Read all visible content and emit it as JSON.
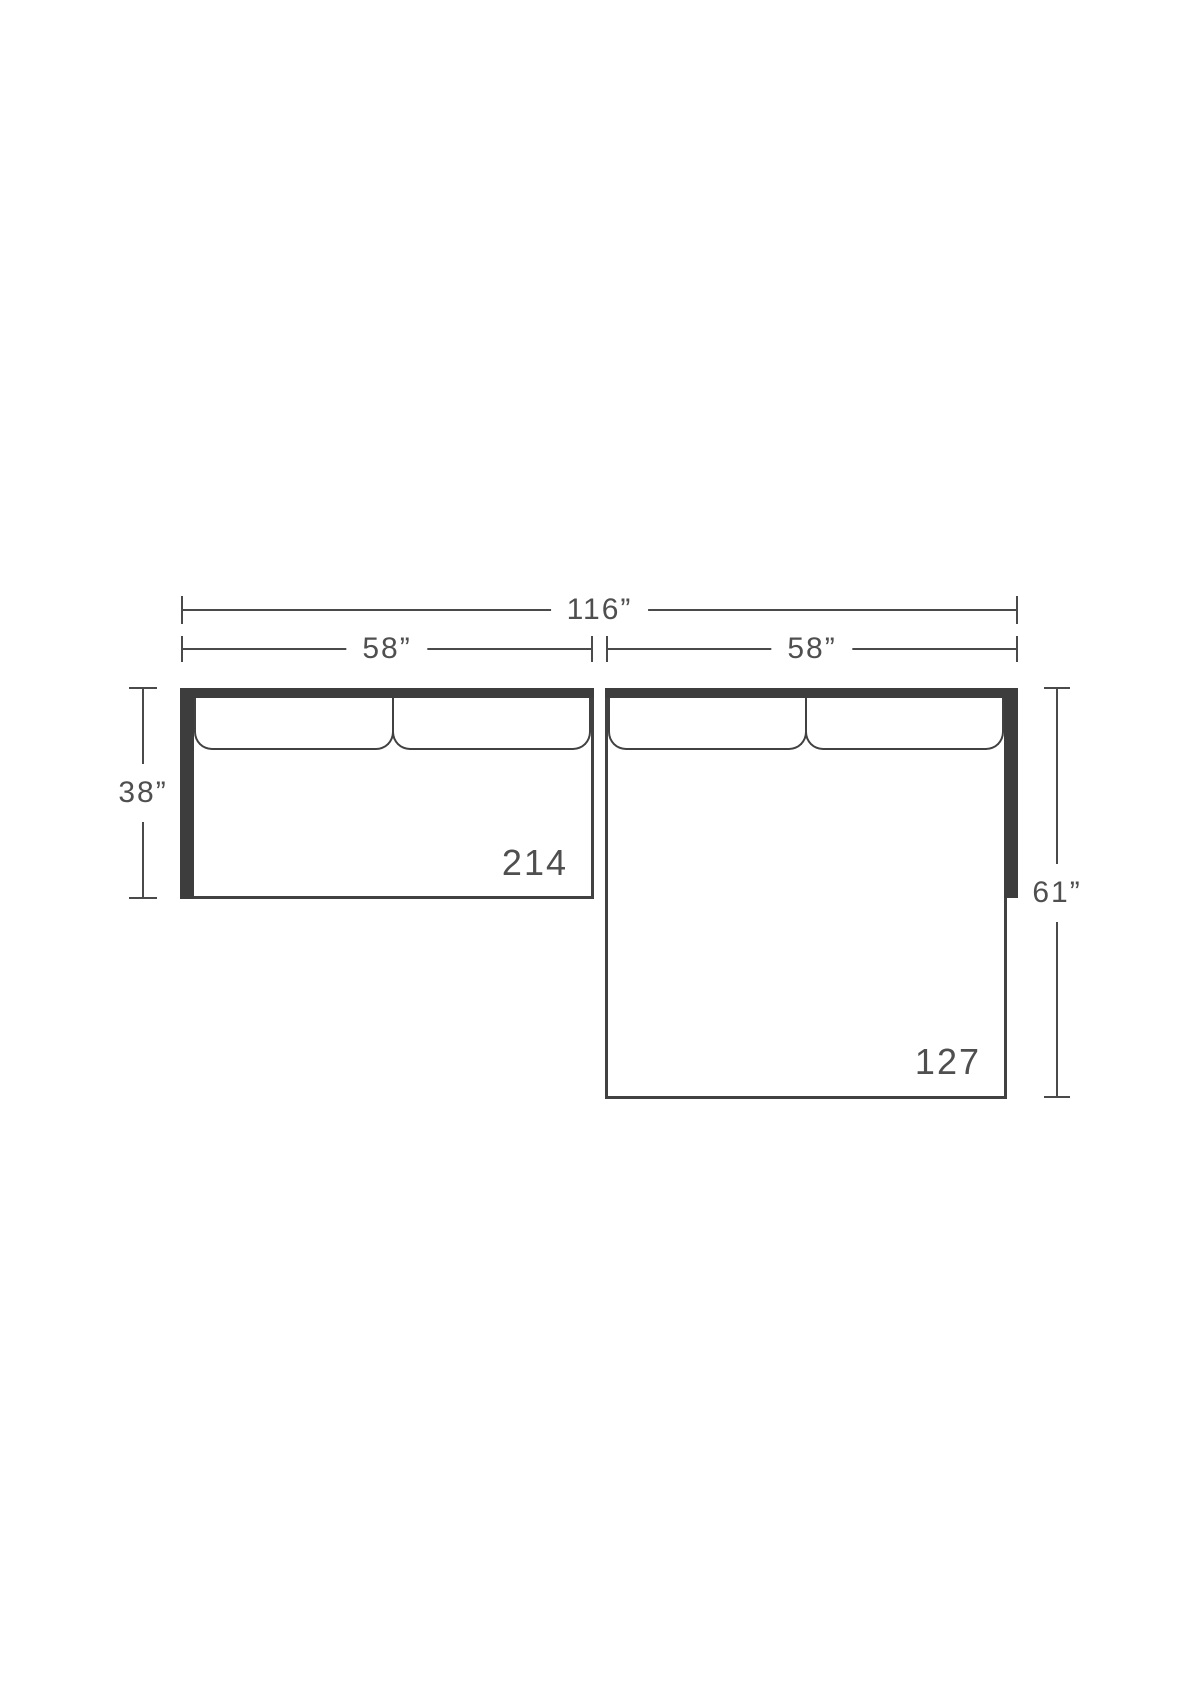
{
  "diagram": {
    "type": "sectional-sofa-top-view-dimension-drawing",
    "dimensions": {
      "total_width": "116”",
      "left_section_width": "58”",
      "right_section_width": "58”",
      "left_section_depth": "38”",
      "right_section_depth": "61”"
    },
    "sections": [
      {
        "id": "left-sofa",
        "model_number": "214",
        "cushion_count": 2
      },
      {
        "id": "right-chaise",
        "model_number": "127",
        "cushion_count": 2
      }
    ],
    "colors": {
      "frame_dark": "#3d3d3d",
      "line": "#414141",
      "dim": "#4a4a4a",
      "text": "#4f4f4f",
      "bg": "#ffffff"
    }
  }
}
